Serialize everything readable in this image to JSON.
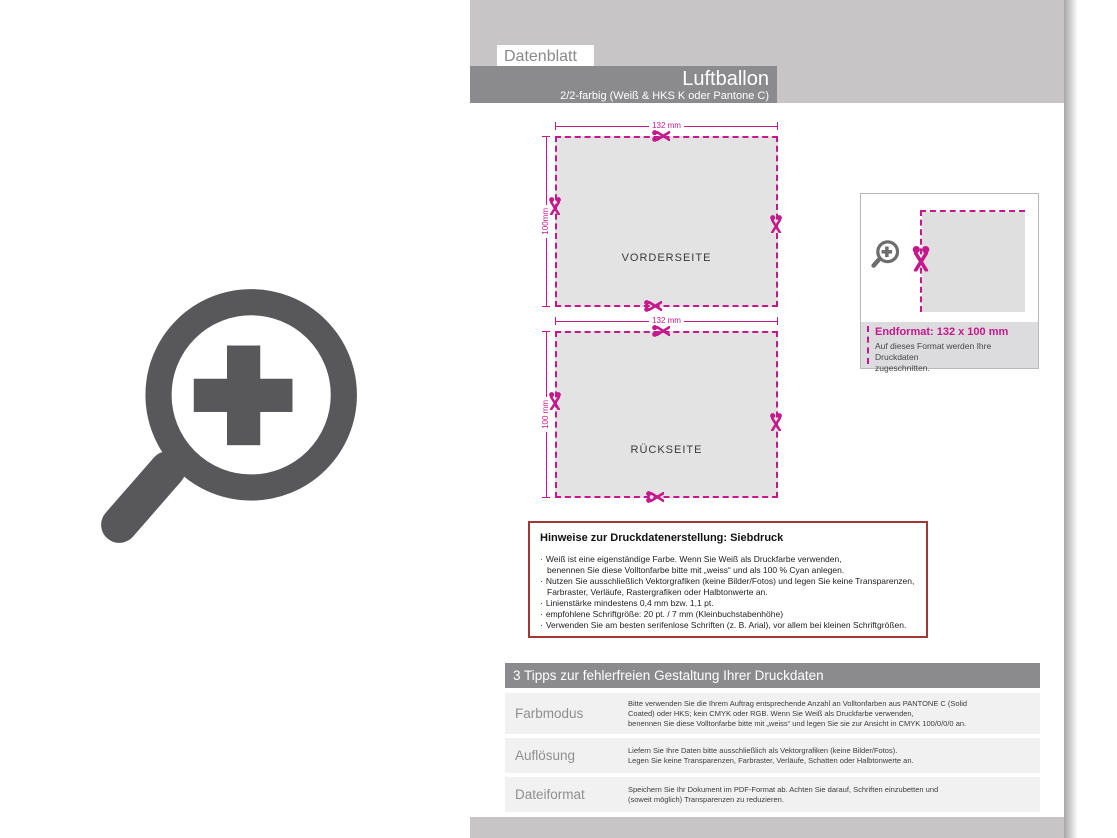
{
  "page": {
    "tab_label": "Datenblatt",
    "product_title": "Luftballon",
    "product_subtitle": "2/2-farbig (Weiß & HKS K oder Pantone C)"
  },
  "colors": {
    "accent_magenta": "#c6188c",
    "band_gray": "#c7c5c6",
    "bar_gray": "#8b8a8d",
    "hinweise_border_red": "#a23737",
    "icon_gray": "#58585a"
  },
  "figures": [
    {
      "name": "VORDERSEITE",
      "width_label": "132 mm",
      "height_label": "100mm"
    },
    {
      "name": "RÜCKSEITE",
      "width_label": "132 mm",
      "height_label": "100 mm"
    }
  ],
  "endformat": {
    "title": "Endformat: 132 x 100 mm",
    "line1": "Auf dieses Format werden Ihre Druckdaten",
    "line2": "zugeschnitten."
  },
  "hinweise": {
    "title": "Hinweise zur Druckdatenerstellung: Siebdruck",
    "bullets": [
      {
        "lines": [
          "Weiß ist eine eigenständige Farbe. Wenn Sie Weiß als Druckfarbe verwenden,",
          "benennen Sie diese Volltonfarbe bitte mit „weiss“ und als 100 % Cyan anlegen."
        ]
      },
      {
        "lines": [
          "Nutzen Sie ausschließlich Vektorgrafiken (keine Bilder/Fotos) und legen Sie keine Transparenzen,",
          "Farbraster, Verläufe, Rastergrafiken oder Halbtonwerte an."
        ]
      },
      {
        "lines": [
          "Linienstärke mindestens 0,4 mm bzw. 1,1 pt."
        ]
      },
      {
        "lines": [
          "empfohlene Schriftgröße: 20 pt. / 7 mm (Kleinbuchstabenhöhe)"
        ]
      },
      {
        "lines": [
          "Verwenden Sie am besten serifenlose Schriften (z. B. Arial), vor allem bei kleinen Schriftgrößen."
        ]
      }
    ]
  },
  "tips": {
    "header": "3 Tipps zur fehlerfreien Gestaltung Ihrer Druckdaten",
    "rows": [
      {
        "label": "Farbmodus",
        "lines": [
          "Bitte verwenden Sie die Ihrem Auftrag entsprechende Anzahl an Volltonfarben aus PANTONE C (Solid",
          "Coated) oder HKS; kein CMYK oder RGB. Wenn Sie Weiß als Druckfarbe verwenden,",
          "benennen Sie diese Volltonfarbe bitte mit „weiss“ und legen Sie sie zur Ansicht in CMYK 100/0/0/0 an."
        ]
      },
      {
        "label": "Auflösung",
        "lines": [
          "Liefern Sie Ihre Daten bitte ausschließlich als Vektorgrafiken (keine Bilder/Fotos).",
          "Legen Sie keine Transparenzen, Farbraster, Verläufe, Schatten oder Halbtonwerte an."
        ]
      },
      {
        "label": "Dateiformat",
        "lines": [
          "Speichern Sie Ihr Dokument im PDF-Format ab. Achten Sie darauf, Schriften einzubetten und",
          "(soweit möglich) Transparenzen zu reduzieren."
        ]
      }
    ]
  }
}
